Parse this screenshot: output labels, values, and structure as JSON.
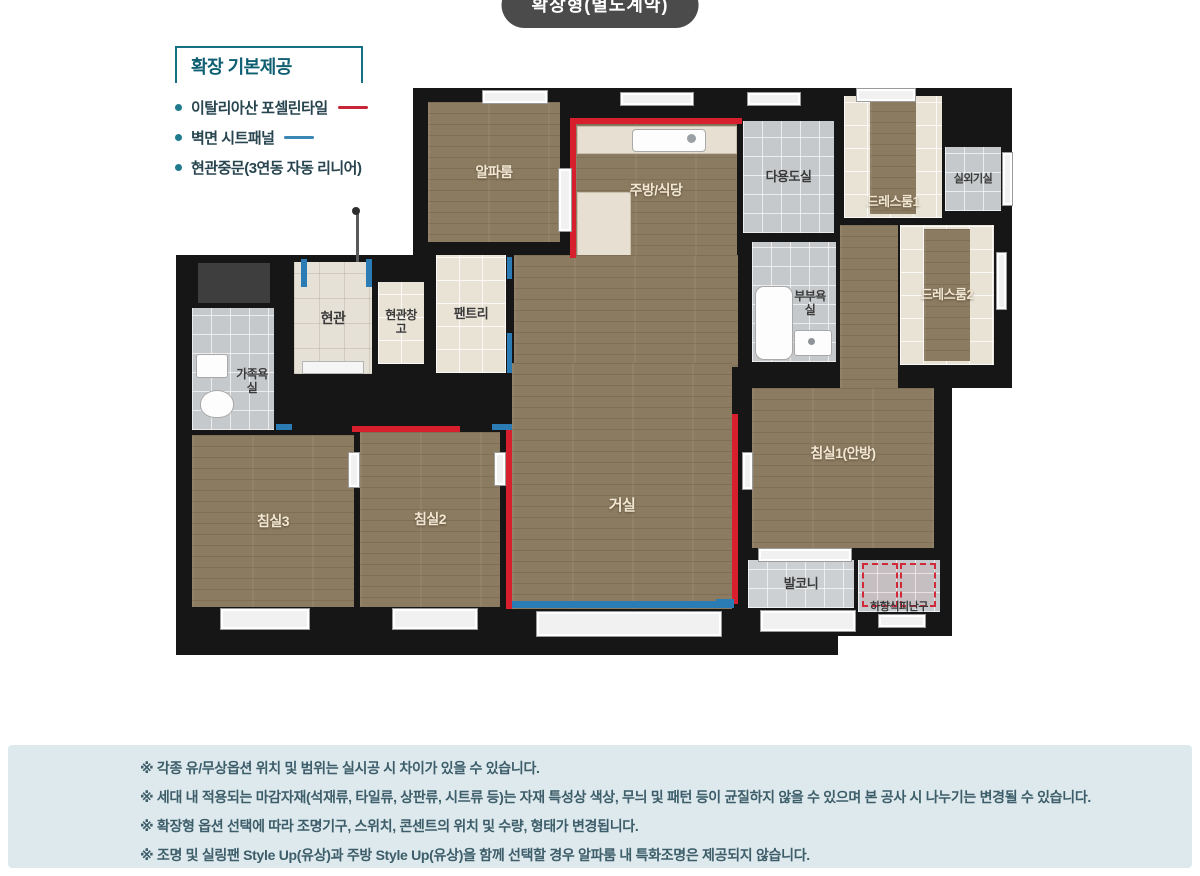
{
  "badge": {
    "label": "확장형(별도계약)"
  },
  "legend": {
    "title": "확장 기본제공",
    "items": [
      {
        "label": "이탈리아산 포셀린타일",
        "line_color": "#c82536"
      },
      {
        "label": "벽면 시트패널",
        "line_color": "#3a87b5"
      },
      {
        "label": "현관중문(3연동 자동 리니어)",
        "line_color": ""
      }
    ]
  },
  "floorplan": {
    "rooms": [
      {
        "id": "alpha-room",
        "label": "알파룸"
      },
      {
        "id": "kitchen-dining",
        "label": "주방/식당"
      },
      {
        "id": "utility-room",
        "label": "다용도실"
      },
      {
        "id": "dress-room-1",
        "label": "드레스룸1"
      },
      {
        "id": "outdoor-unit-room",
        "label": "실외기실"
      },
      {
        "id": "pantry",
        "label": "팬트리"
      },
      {
        "id": "entrance",
        "label": "현관"
      },
      {
        "id": "entrance-storage",
        "label": "현관창고"
      },
      {
        "id": "master-bathroom",
        "label": "부부욕실"
      },
      {
        "id": "dress-room-2",
        "label": "드레스룸2"
      },
      {
        "id": "family-bathroom",
        "label": "가족욕실"
      },
      {
        "id": "bedroom-3",
        "label": "침실3"
      },
      {
        "id": "bedroom-2",
        "label": "침실2"
      },
      {
        "id": "living-room",
        "label": "거실"
      },
      {
        "id": "bedroom-1",
        "label": "침실1(안방)"
      },
      {
        "id": "balcony",
        "label": "발코니"
      },
      {
        "id": "escape-hatch",
        "label": "하향식피난구"
      }
    ],
    "accent_colors": {
      "porcelain_tile_line": "#d81f2e",
      "sheet_panel_line": "#2b7cb4",
      "wall": "#161616",
      "wood_floor": "#8b7b61"
    }
  },
  "notes": {
    "items": [
      "※ 각종 유/무상옵션 위치 및 범위는 실시공 시 차이가 있을 수 있습니다.",
      "※ 세대 내 적용되는 마감자재(석재류, 타일류, 상판류, 시트류 등)는 자재 특성상 색상, 무늬 및 패턴 등이 균질하지 않을 수 있으며 본 공사 시 나누기는 변경될 수 있습니다.",
      "※ 확장형 옵션 선택에 따라 조명기구, 스위치, 콘센트의 위치 및 수량, 형태가 변경됩니다.",
      "※ 조명 및 실링팬 Style Up(유상)과 주방 Style Up(유상)을 함께 선택할 경우 알파룸 내 특화조명은 제공되지 않습니다."
    ]
  }
}
